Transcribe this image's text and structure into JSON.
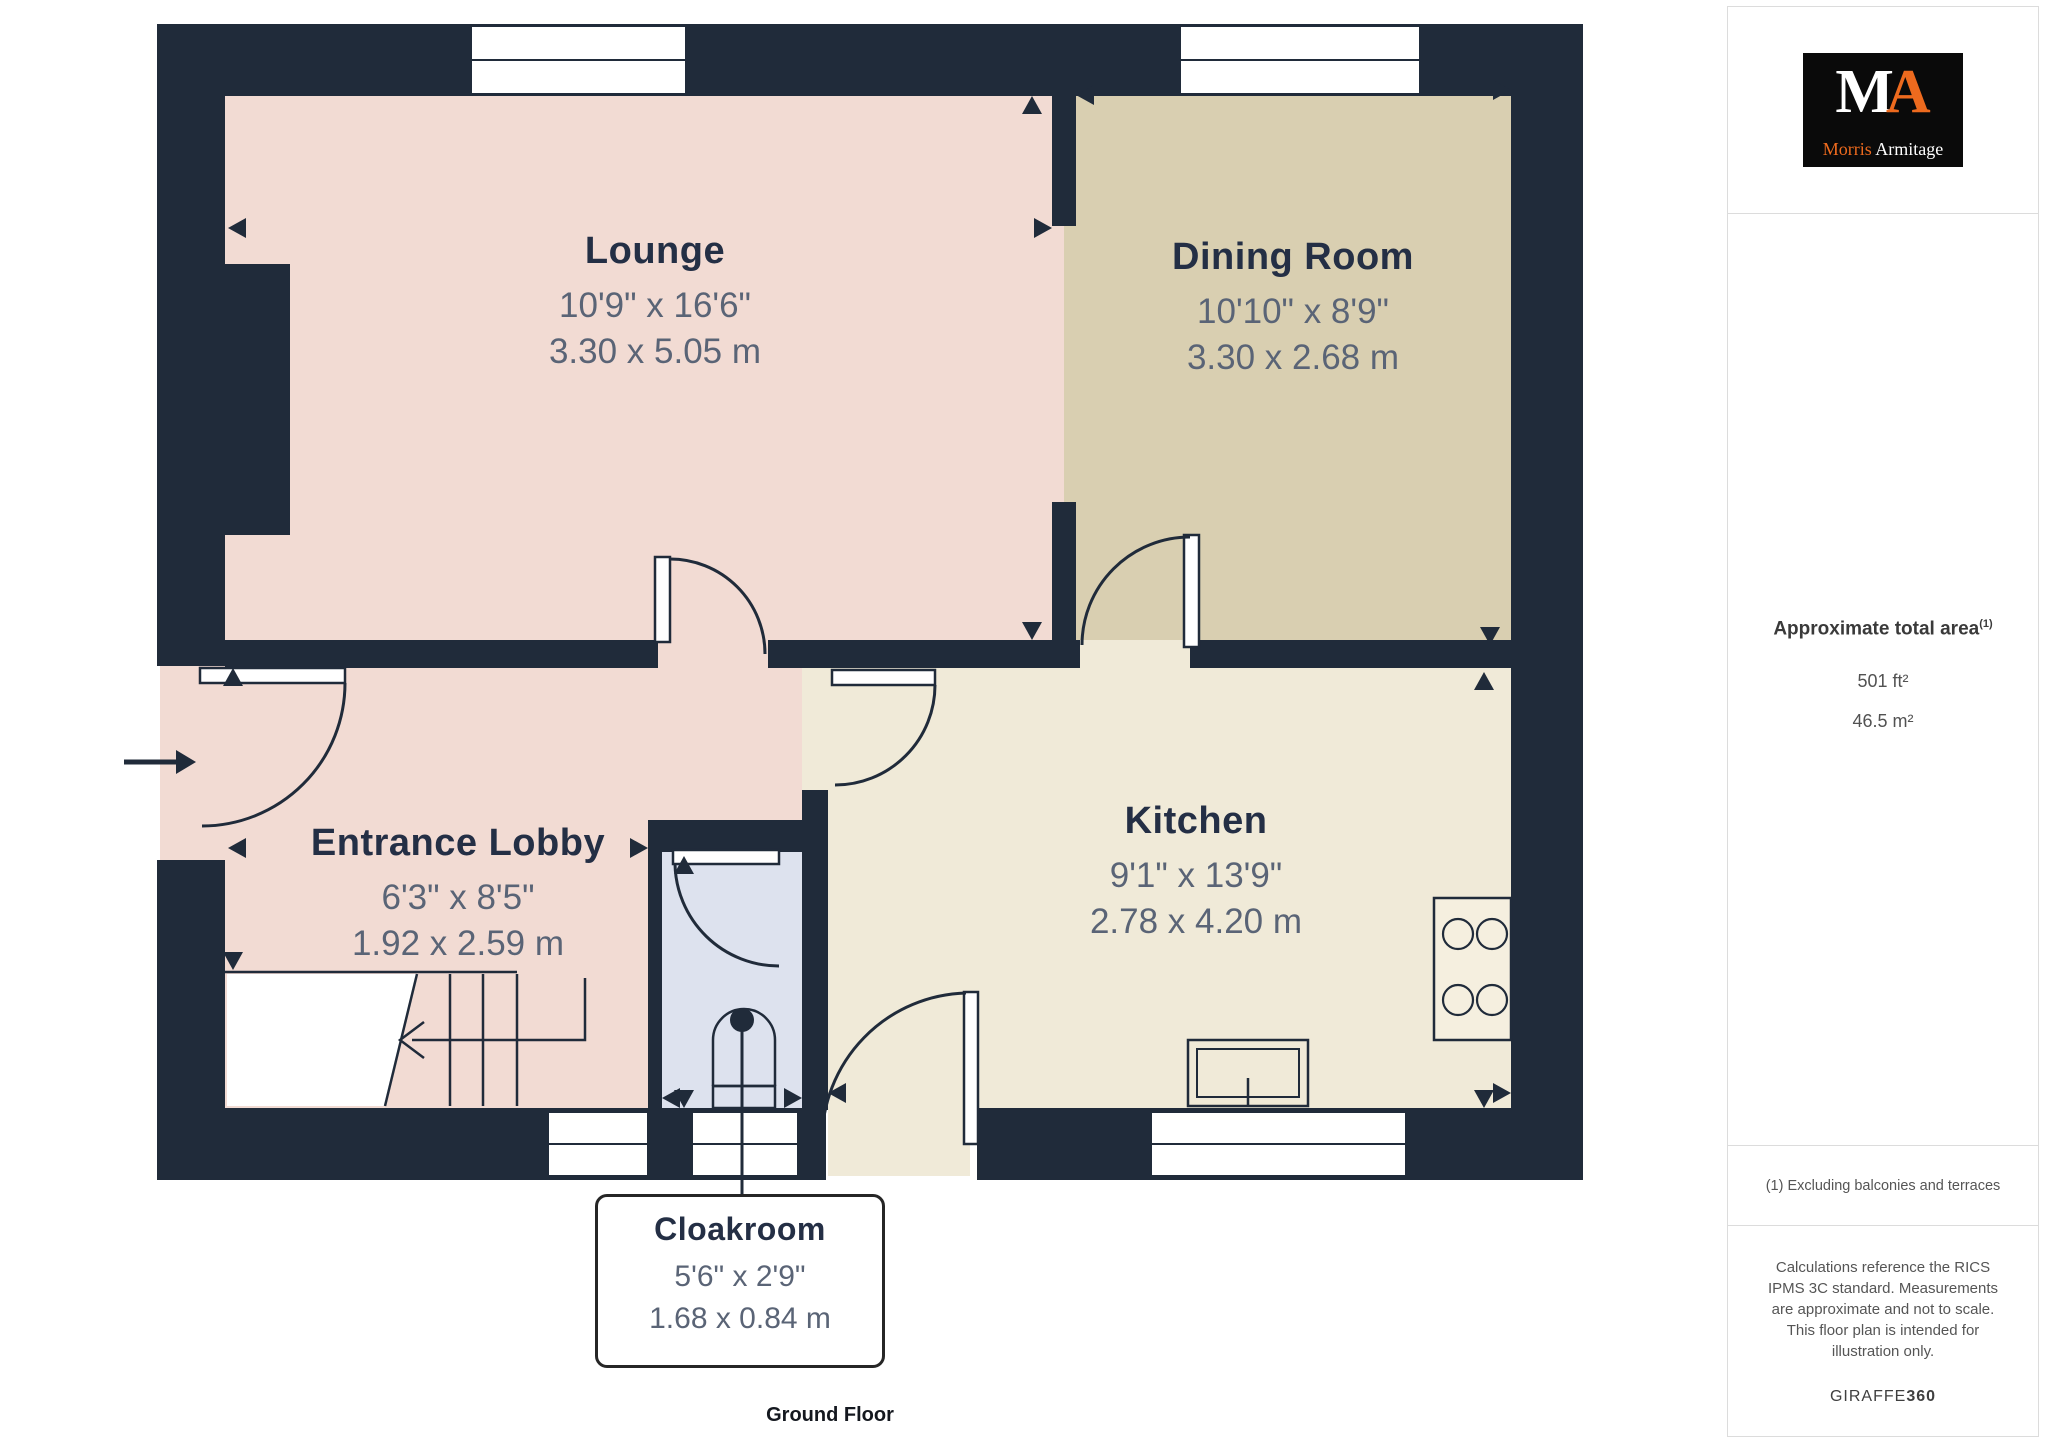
{
  "plan": {
    "floor_label": "Ground Floor",
    "rooms": [
      {
        "name": "Lounge",
        "imperial": "10'9\" x 16'6\"",
        "metric": "3.30 x 5.05 m"
      },
      {
        "name": "Dining Room",
        "imperial": "10'10\" x 8'9\"",
        "metric": "3.30 x 2.68 m"
      },
      {
        "name": "Entrance Lobby",
        "imperial": "6'3\" x 8'5\"",
        "metric": "1.92 x 2.59 m"
      },
      {
        "name": "Kitchen",
        "imperial": "9'1\" x 13'9\"",
        "metric": "2.78 x 4.20 m"
      },
      {
        "name": "Cloakroom",
        "imperial": "5'6\" x 2'9\"",
        "metric": "1.68 x 0.84 m"
      }
    ],
    "colors": {
      "wall": "#202B3A",
      "lounge_fill": "#F2DBD3",
      "dining_fill": "#D9CFB1",
      "kitchen_fill": "#F0EAD8",
      "cloakroom_fill": "#DDE2EE",
      "label_title": "#242F45",
      "label_dims": "#5A6476"
    }
  },
  "sidebar": {
    "logo": {
      "monogram_m": "M",
      "monogram_a": "A",
      "word_morris": "Morris",
      "word_armitage": "Armitage",
      "accent_orange": "#ED6A1E"
    },
    "area": {
      "title": "Approximate total area",
      "sup": "(1)",
      "imperial": "501 ft²",
      "metric": "46.5 m²"
    },
    "footnote": "(1) Excluding balconies and terraces",
    "disclaimer": "Calculations reference the RICS IPMS 3C standard. Measurements are approximate and not to scale. This floor plan is intended for illustration only.",
    "brand": {
      "giraffe": "GIRAFFE",
      "three_sixty": "360"
    }
  }
}
